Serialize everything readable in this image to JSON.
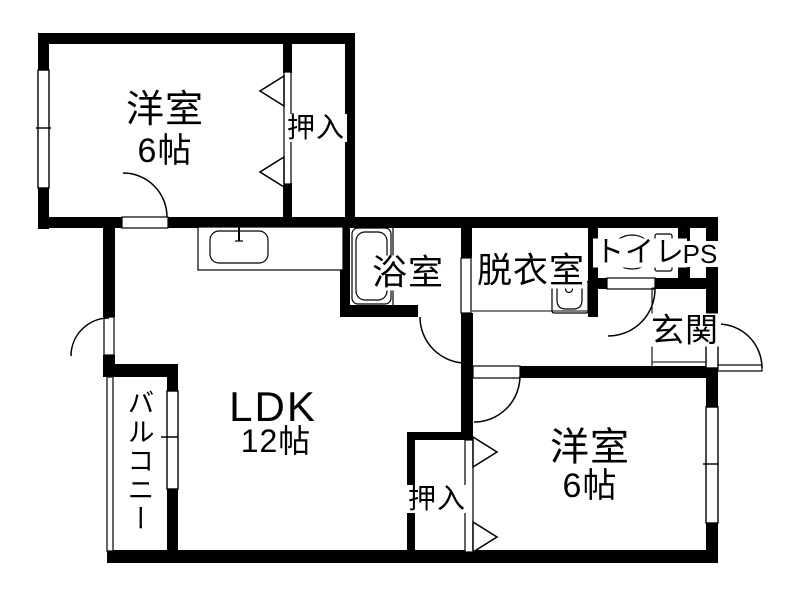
{
  "floorplan": {
    "background": "#ffffff",
    "wall_color": "#000000",
    "line_color": "#000000",
    "rooms": {
      "bedroom1": {
        "label": "洋室",
        "size": "6帖"
      },
      "closet1": {
        "label": "押入"
      },
      "bathroom": {
        "label": "浴室"
      },
      "dressing_room": {
        "label": "脱衣室"
      },
      "toilet": {
        "label": "トイレ"
      },
      "pipe_space": {
        "label": "PS"
      },
      "entrance": {
        "label": "玄関"
      },
      "ldk": {
        "label": "LDK",
        "size": "12帖"
      },
      "closet2": {
        "label": "押入"
      },
      "bedroom2": {
        "label": "洋室",
        "size": "6帖"
      },
      "balcony": {
        "label": "バルコニー"
      }
    }
  }
}
